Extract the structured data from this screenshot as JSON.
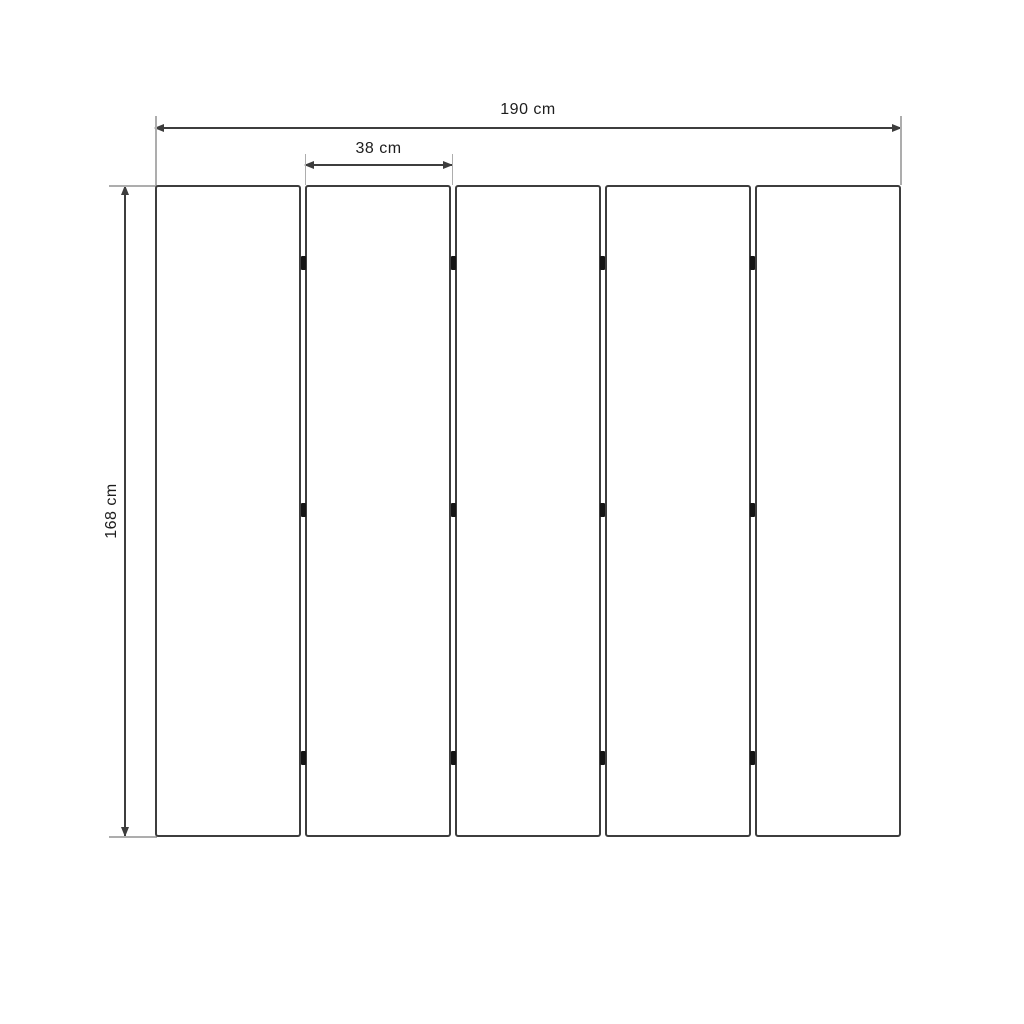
{
  "diagram": {
    "units": "cm",
    "dimensions": {
      "total_width": {
        "label": "190 cm",
        "value": 190,
        "orientation": "horizontal"
      },
      "panel_width": {
        "label": "38 cm",
        "value": 38,
        "orientation": "horizontal"
      },
      "height": {
        "label": "168 cm",
        "value": 168,
        "orientation": "vertical"
      }
    },
    "panels": {
      "count": 5
    },
    "hinges": {
      "gap_count": 4,
      "rows_per_gap": 3
    },
    "colors": {
      "background": "#ffffff",
      "line": "#3d3d3d",
      "extension_line": "#adadad",
      "text": "#1d1d1d",
      "hinge": "#141414",
      "panel_fill": "#ffffff"
    }
  }
}
